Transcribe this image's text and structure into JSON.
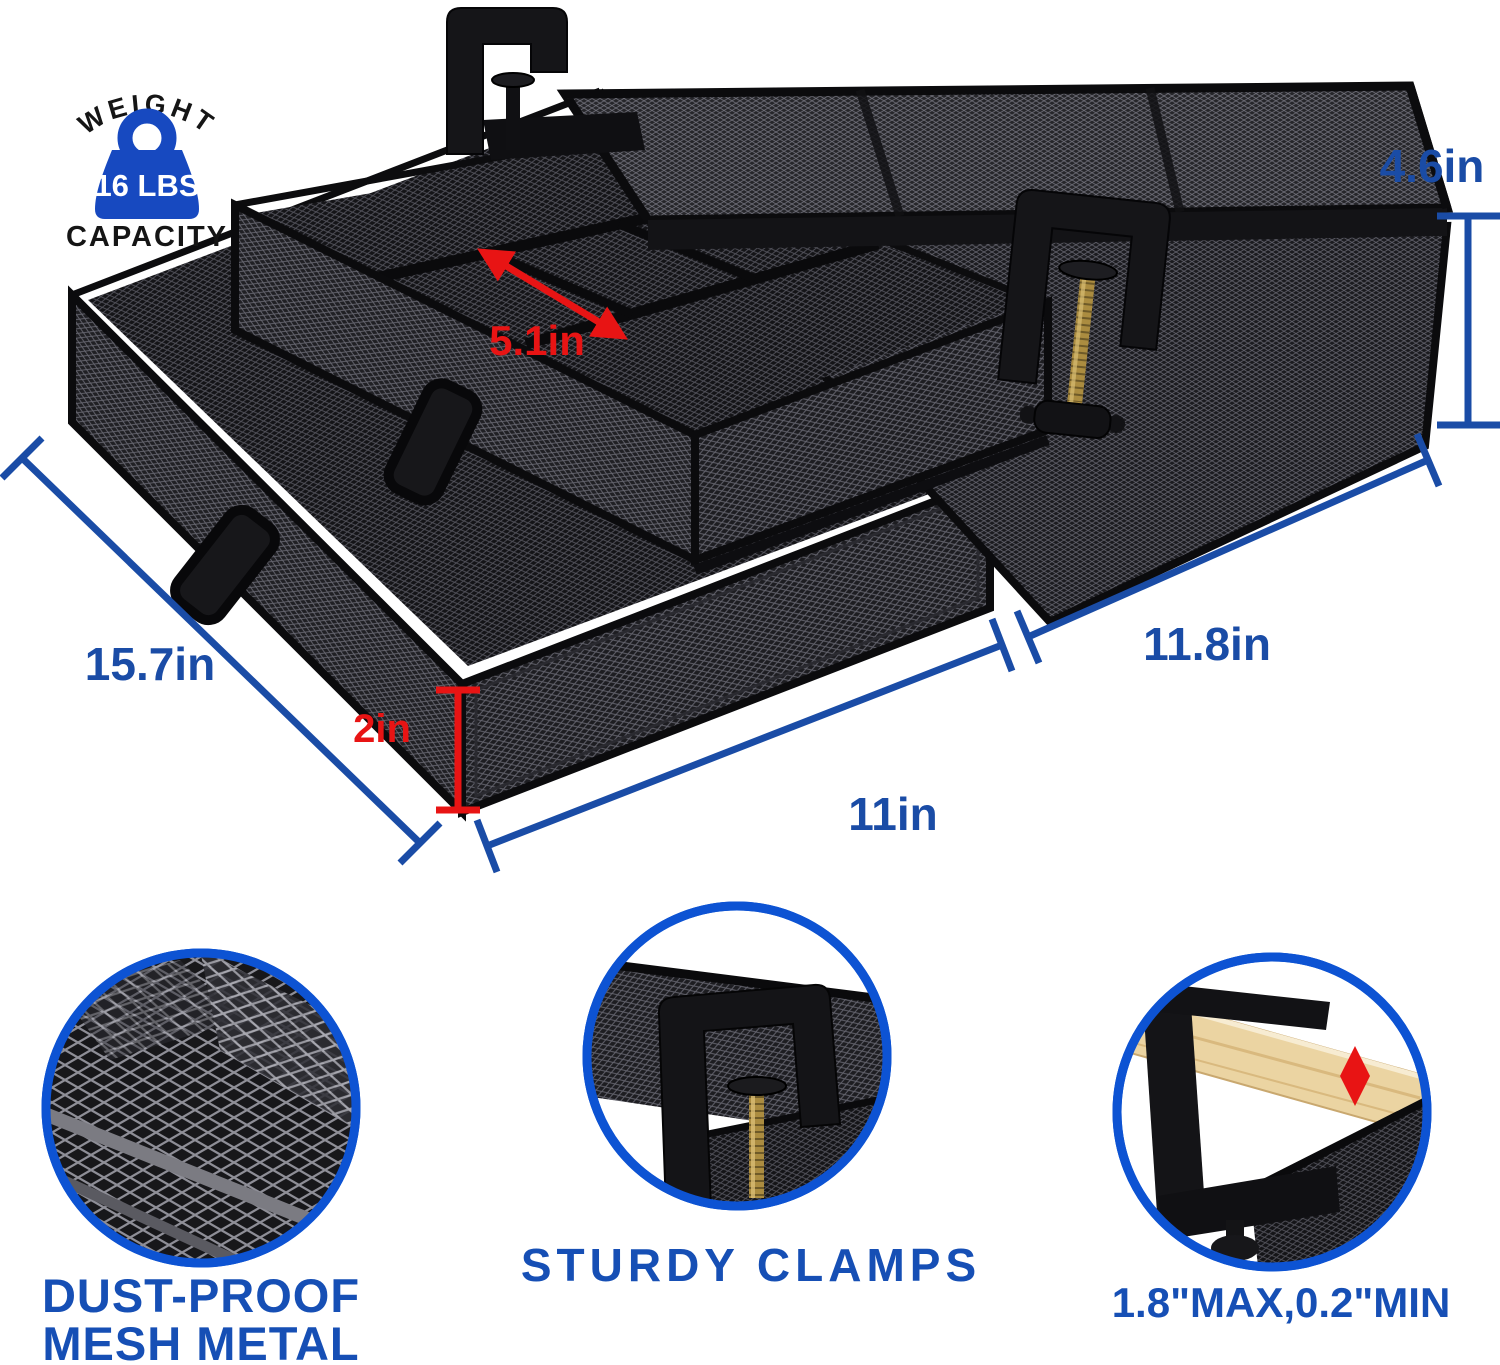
{
  "weight_badge": {
    "arc_text": "WEIGHT",
    "value": "16 LBS",
    "caption": "CAPACITY"
  },
  "dimensions": {
    "top_height": "4.6in",
    "compartment_width": "5.1in",
    "depth": "15.7in",
    "drawer_height": "2in",
    "top_width": "11.8in",
    "drawer_width": "11in"
  },
  "features": [
    {
      "id": "mesh-metal",
      "lines": [
        "DUST-PROOF",
        "MESH METAL"
      ]
    },
    {
      "id": "sturdy-clamps",
      "lines": [
        "STURDY CLAMPS"
      ]
    },
    {
      "id": "clamp-range",
      "lines": [
        "1.8\"MAX,0.2\"MIN"
      ]
    }
  ],
  "colors": {
    "dimension_blue": "#1A4CA6",
    "caption_blue": "#164FB5",
    "ring_blue": "#0D53D3",
    "badge_blue": "#1749C0",
    "annotation_red": "#E81414",
    "product_black": "#141417",
    "brass": "#AB8C40",
    "wood": "#EBD4A2"
  }
}
